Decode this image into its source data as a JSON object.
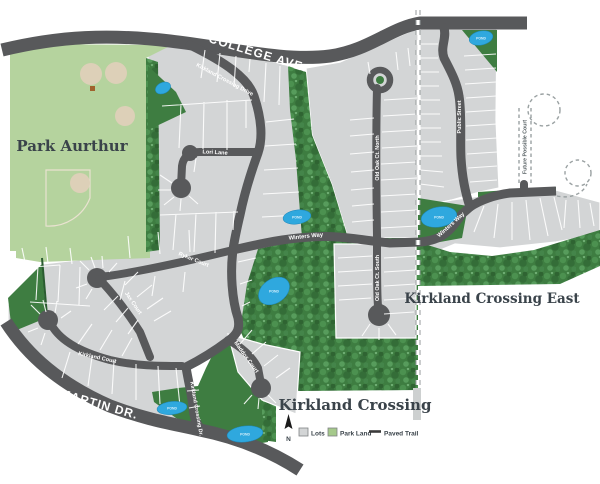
{
  "map": {
    "area_labels": {
      "park": "Park Aurthur",
      "development": "Kirkland Crossing",
      "development_east": "Kirkland Crossing East"
    },
    "road_labels": {
      "college_ave": "COLLEGE AVE.",
      "martin_dr": "MARTIN DR.",
      "kirkland_crossing_drive": "Kirkland Crossing Drive",
      "kirkland_crossing_dr_short": "Kirkland Crossing Dr.",
      "lori_lane": "Lori Lane",
      "ryker_court": "Ryker Court",
      "jax_court": "Jax Court",
      "kirkland_court": "Kirkland Court",
      "maddox_court": "Maddox Court",
      "winters_way": "Winters Way",
      "old_oak_ct_north": "Old Oak Ct. North",
      "old_oak_ct_south": "Old Oak Ct. South",
      "public_street": "Public Street",
      "future_possible_court": "Future Possible Court"
    },
    "pond_label": "POND",
    "legend": {
      "north": "N",
      "items": [
        {
          "label": "Lots",
          "swatch": "#d3d5d6"
        },
        {
          "label": "Park Land",
          "swatch": "#a5c98b"
        },
        {
          "label": "Paved Trail",
          "swatch": "#3a3a3a"
        }
      ]
    },
    "colors": {
      "road": "#58595b",
      "lots": "#d3d5d6",
      "park_land_light": "#b5d39e",
      "park_land_dark": "#3e7d41",
      "pond": "#2fa8de",
      "label_dark": "#3a434a",
      "road_label": "#ffffff"
    }
  }
}
